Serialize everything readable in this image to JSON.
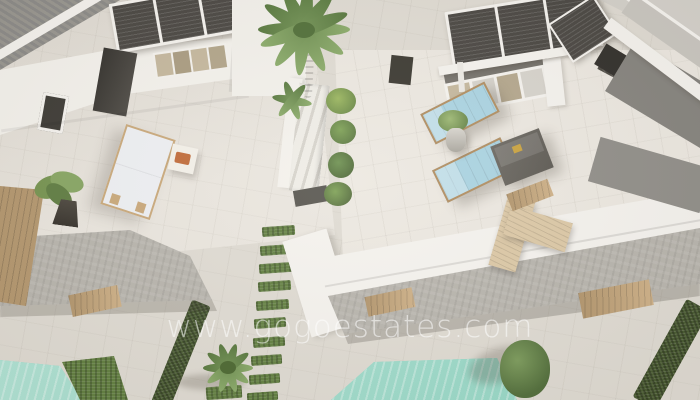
{
  "scene": {
    "watermark": "www.gogoestates.com",
    "objects": [
      "villa-rooftops",
      "solar-panels",
      "roof-terraces",
      "sun-loungers",
      "palm-trees",
      "garden-path-grass-strips",
      "hedges",
      "swimming-pools",
      "concrete-slab-roofs",
      "wooden-deck"
    ]
  },
  "palette": {
    "stone": "#dfdbd3",
    "terrace": "#eae6df",
    "white-wall": "#f5f3ef",
    "slab": "#b7b4ad",
    "roof-dark": "#8e8d8a",
    "panel": "#474440",
    "wood": "#c9a87a",
    "wood-dark": "#b08c5f",
    "wood-light": "#dcc8a6",
    "grass": "#5f7d3e",
    "hedge": "#45582e",
    "pool": "#8ed5c3",
    "pool-light": "#b9e7da",
    "lounger-blue": "#a9d3e2",
    "lounger-white": "#eef0f4",
    "ottoman": "#5a5751",
    "tan": "#c4b79d",
    "orange": "#c06a38",
    "watermark-white": "#ffffff"
  }
}
